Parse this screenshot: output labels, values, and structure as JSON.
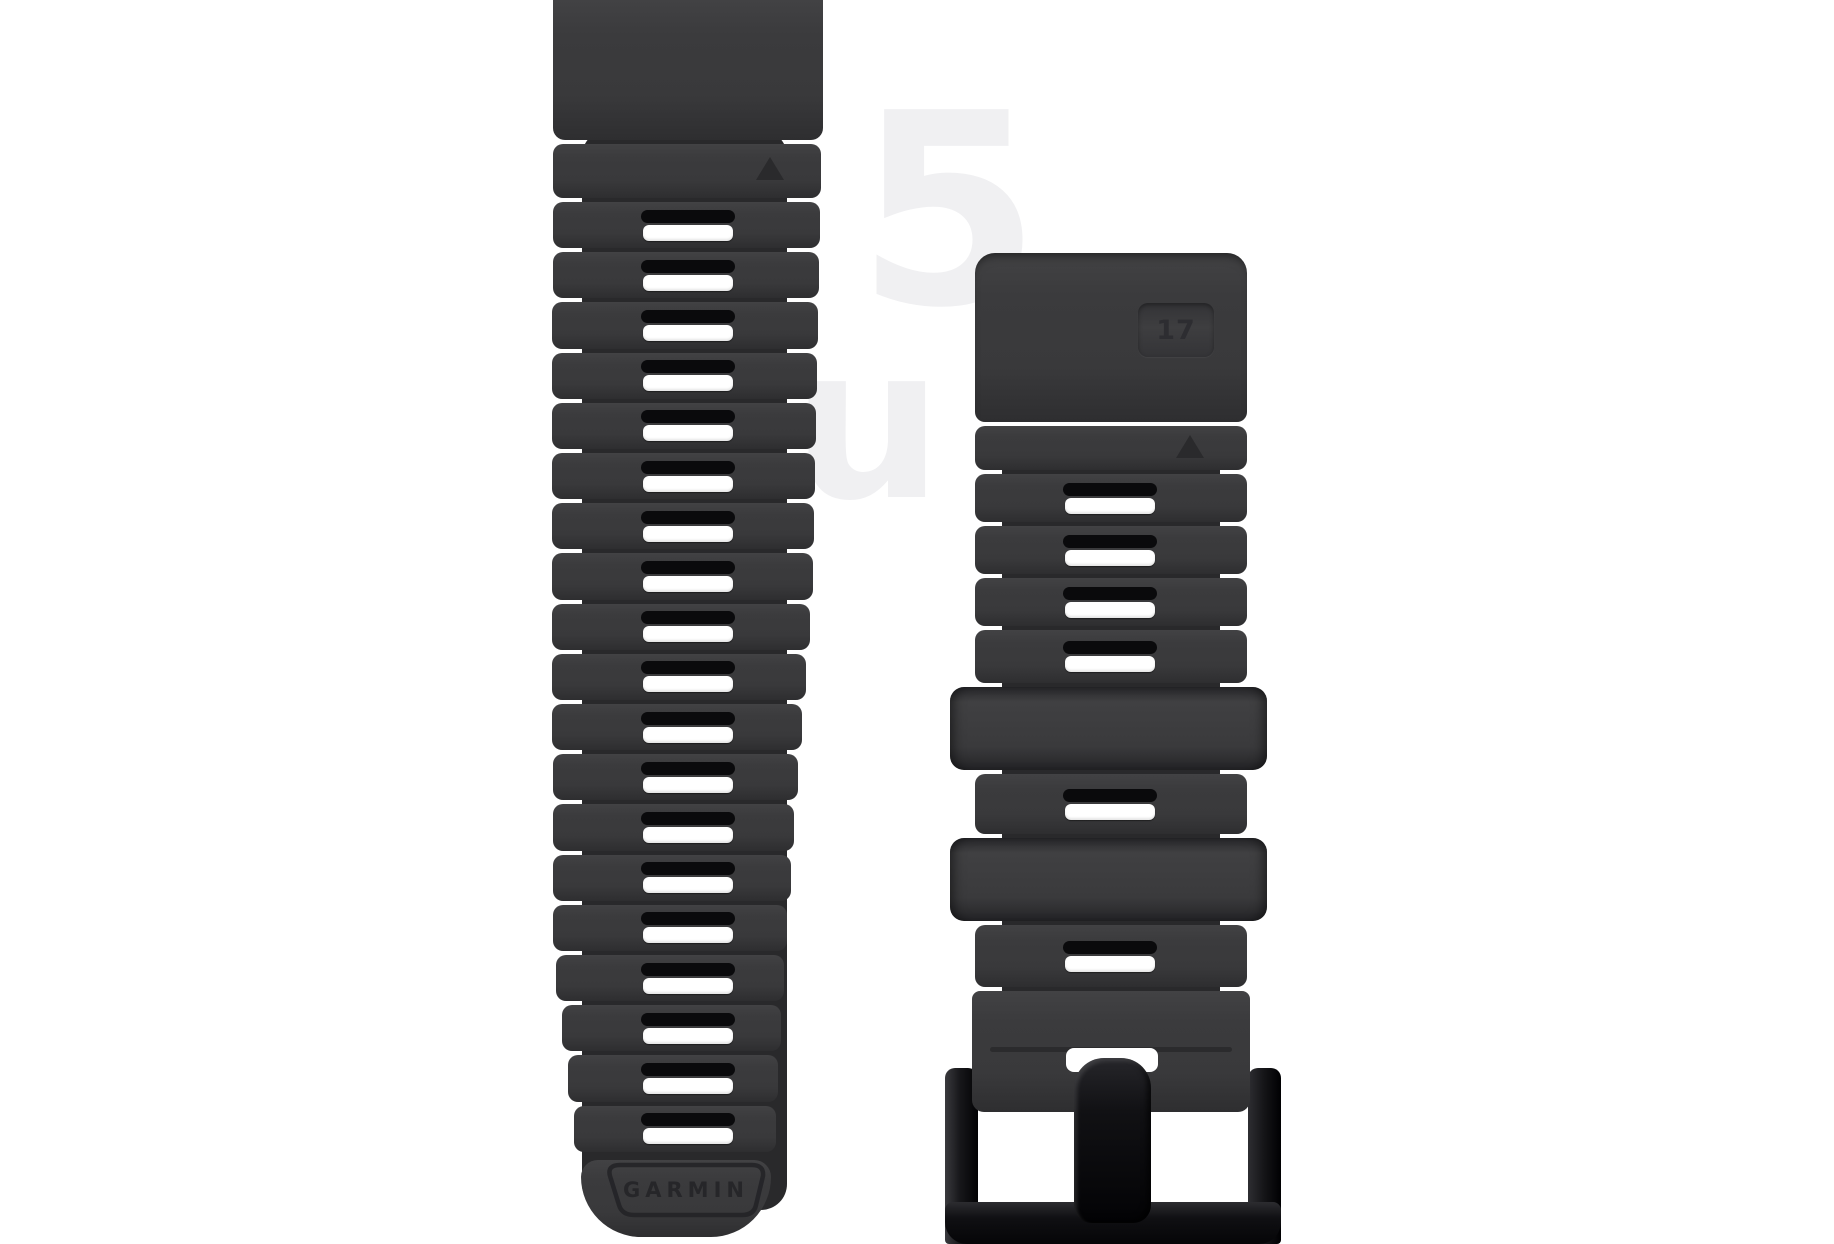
{
  "image": {
    "subject": "Garmin QuickFit watch band - two-piece graphite silicone strap with black pin buckle, product photo on white",
    "background_color": "#ffffff"
  },
  "palette": {
    "strap": "#3a3a3c",
    "strap_highlight": "#424244",
    "strap_shadow": "#2e2e30",
    "groove": "#29292b",
    "slot_slit": "#0a0a0c",
    "slot_hole": "#ffffff",
    "buckle": "#121215",
    "buckle_deep": "#050507",
    "emboss": "#242427"
  },
  "left_strap": {
    "slot_count": 19,
    "triangle_marker": true,
    "logo_text": "GARMIN"
  },
  "right_strap": {
    "sections": [
      "block",
      "triangle-band",
      "slot-band",
      "slot-band",
      "slot-band",
      "slot-band",
      "keeper",
      "slot-band",
      "keeper",
      "slot-band",
      "tail"
    ],
    "slot_count": 6,
    "keeper_count": 2,
    "triangle_marker": true,
    "badge_text": "17"
  },
  "buckle": {
    "style": "black pin buckle",
    "parts": [
      "left-post",
      "right-post",
      "bottom-bar",
      "prong"
    ]
  },
  "watermark": {
    "glyph_top": "5",
    "glyph_bottom": "u"
  }
}
